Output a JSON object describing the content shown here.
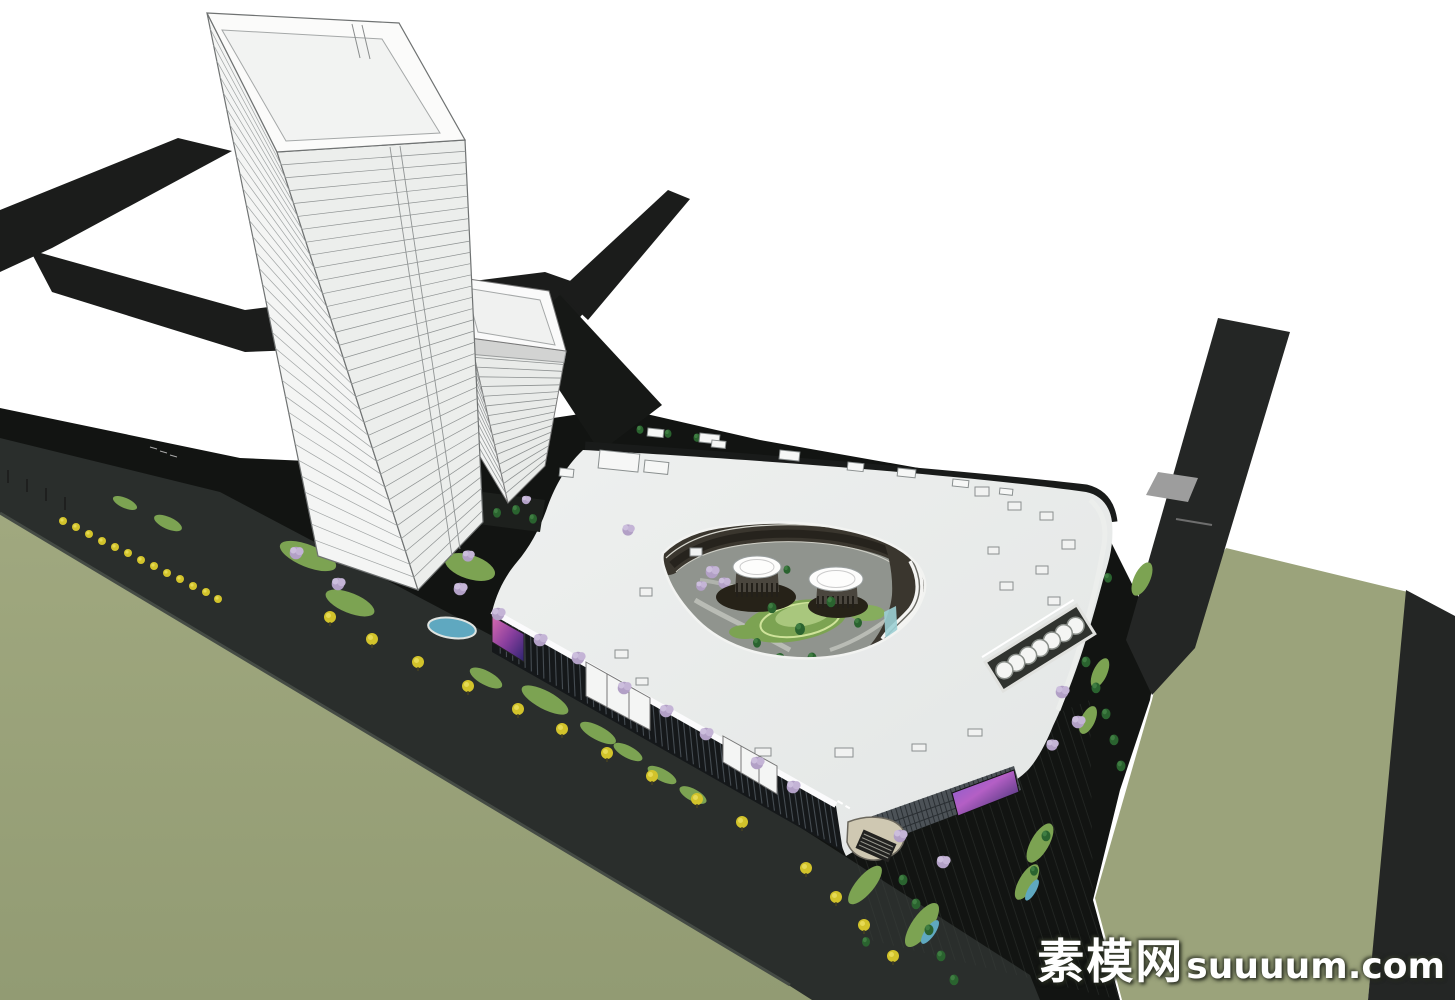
{
  "watermark": {
    "site_name_cn": "素模网",
    "site_domain": "suuuum.com",
    "full_text": "素模网suuuum.com"
  },
  "palette": {
    "background": "#ffffff",
    "road_dark": "#1b1c1b",
    "road_right": "#242625",
    "plaza_black": "#121412",
    "boulevard_gray": "#2a2e2c",
    "field_green": "#9ba37b",
    "lawn_green": "#7ca352",
    "lawn_light": "#a9c77d",
    "conifer_green": "#2a632f",
    "yellow_tree": "#d2c32b",
    "purple_tree": "#b2a0c6",
    "pond_blue": "#5fa8c0",
    "roof_light": "#e9ebe9",
    "skylight_blue": "#c7dde7",
    "fascia_white": "#fbfbfc",
    "glass_dark": "#15181a",
    "courtyard_ring": "#3a362e",
    "ramp_gray": "#9d9d9d"
  },
  "scene_labels": {
    "primary_tower": "high-rise office tower",
    "secondary_tower": "mid-rise tower",
    "mall": "shopping mall podium with teardrop courtyard"
  }
}
